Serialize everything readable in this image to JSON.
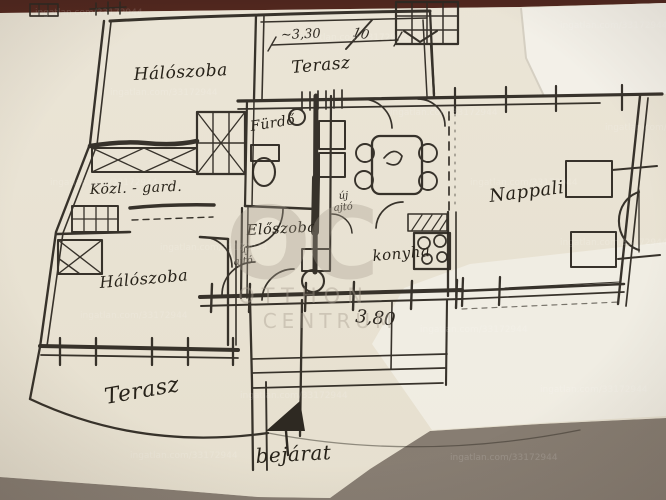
{
  "labels": {
    "bedroom_top": "Hálószoba",
    "terrace_top": "Terasz",
    "bathroom": "Fürdő",
    "corridor_wardrobe": "Közl. - gard.",
    "entry_hall": "Előszoba",
    "kitchen": "konyha",
    "living_room": "Nappali",
    "bedroom_bottom": "Hálószoba",
    "terrace_bottom": "Terasz",
    "entrance": "bejárat"
  },
  "dimensions": {
    "terrace_width": "~3,30",
    "terrace_count": "10",
    "hall_width": "3,80"
  },
  "notes": {
    "new_door_word1": "új",
    "new_door_word2": "ajtó"
  },
  "watermark": {
    "tile_text": "ingatlan.com/33172944",
    "logo": "OC",
    "brand_word1": "OTTHON",
    "brand_word2": "CENTRUM"
  },
  "colors": {
    "ink": "#2e2922",
    "paper": "#e9e3d4",
    "paper_overlay": "#f3f0e8",
    "table_dark": "#4e261e",
    "table_light": "#8d8478",
    "watermark": "#a89f90"
  }
}
